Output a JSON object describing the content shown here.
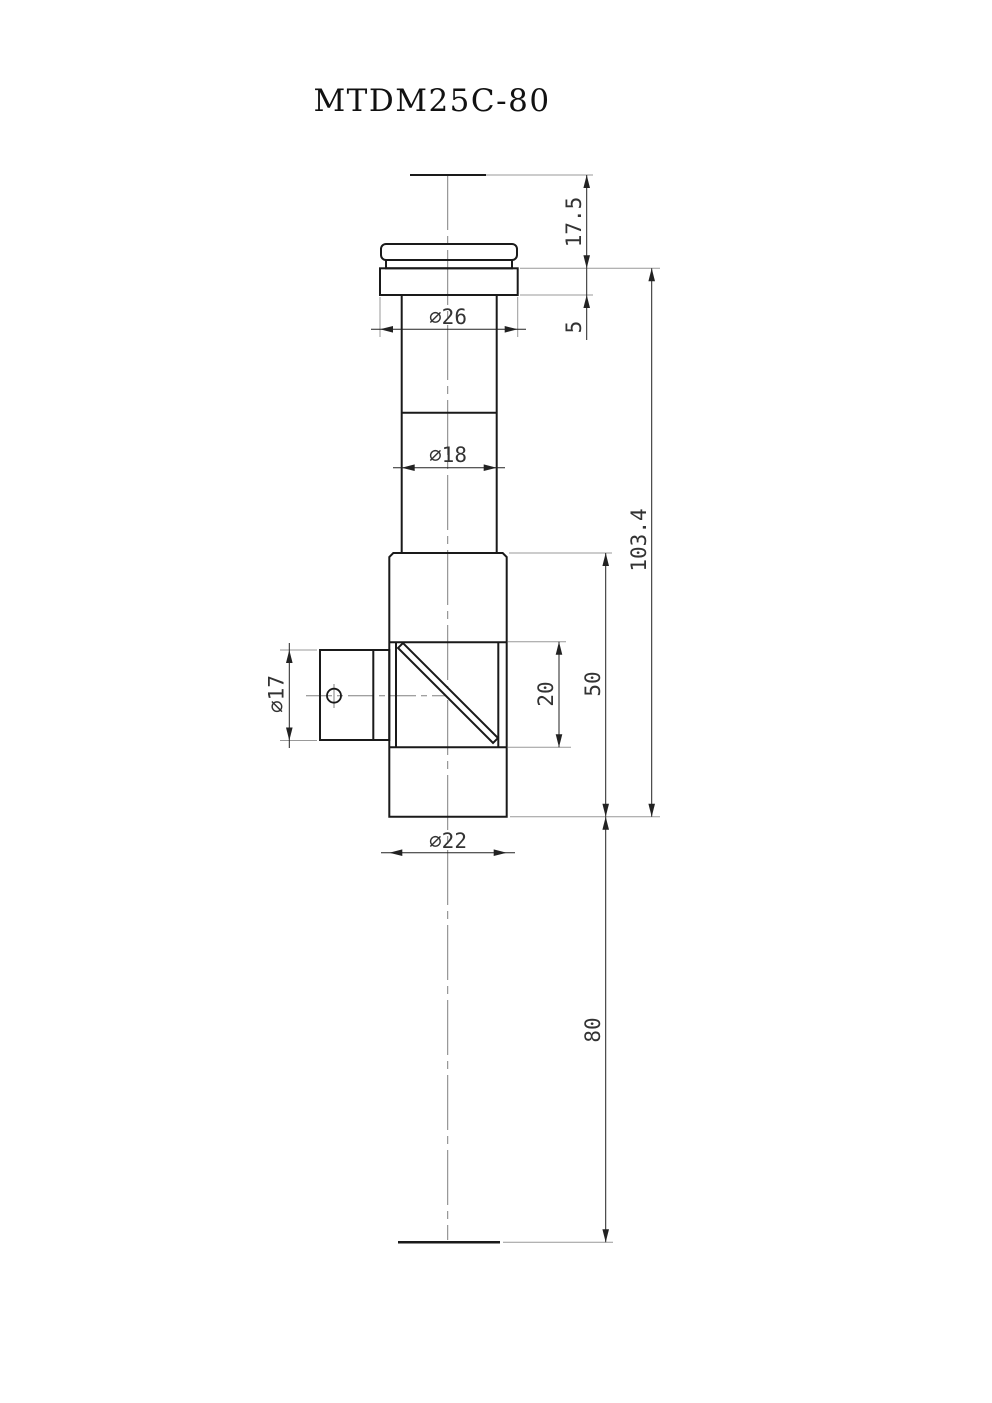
{
  "title": "MTDM25C-80",
  "dimensions": {
    "flange_diameter": {
      "label": "∅26"
    },
    "shaft_diameter": {
      "label": "∅18"
    },
    "body_diameter": {
      "label": "∅22"
    },
    "side_port_diameter": {
      "label": "∅17"
    },
    "top_offset": {
      "label": "17.5"
    },
    "flange_thickness": {
      "label": "5"
    },
    "overall_length": {
      "label": "103.4"
    },
    "body_length": {
      "label": "50"
    },
    "cube_aperture": {
      "label": "20"
    },
    "working_distance": {
      "label": "80"
    }
  },
  "colors": {
    "outline": "#1a1a1a",
    "dimension_line": "#222222",
    "dimension_text": "#333333",
    "extension_line": "#999999",
    "centerline": "#808080",
    "background": "#ffffff"
  }
}
